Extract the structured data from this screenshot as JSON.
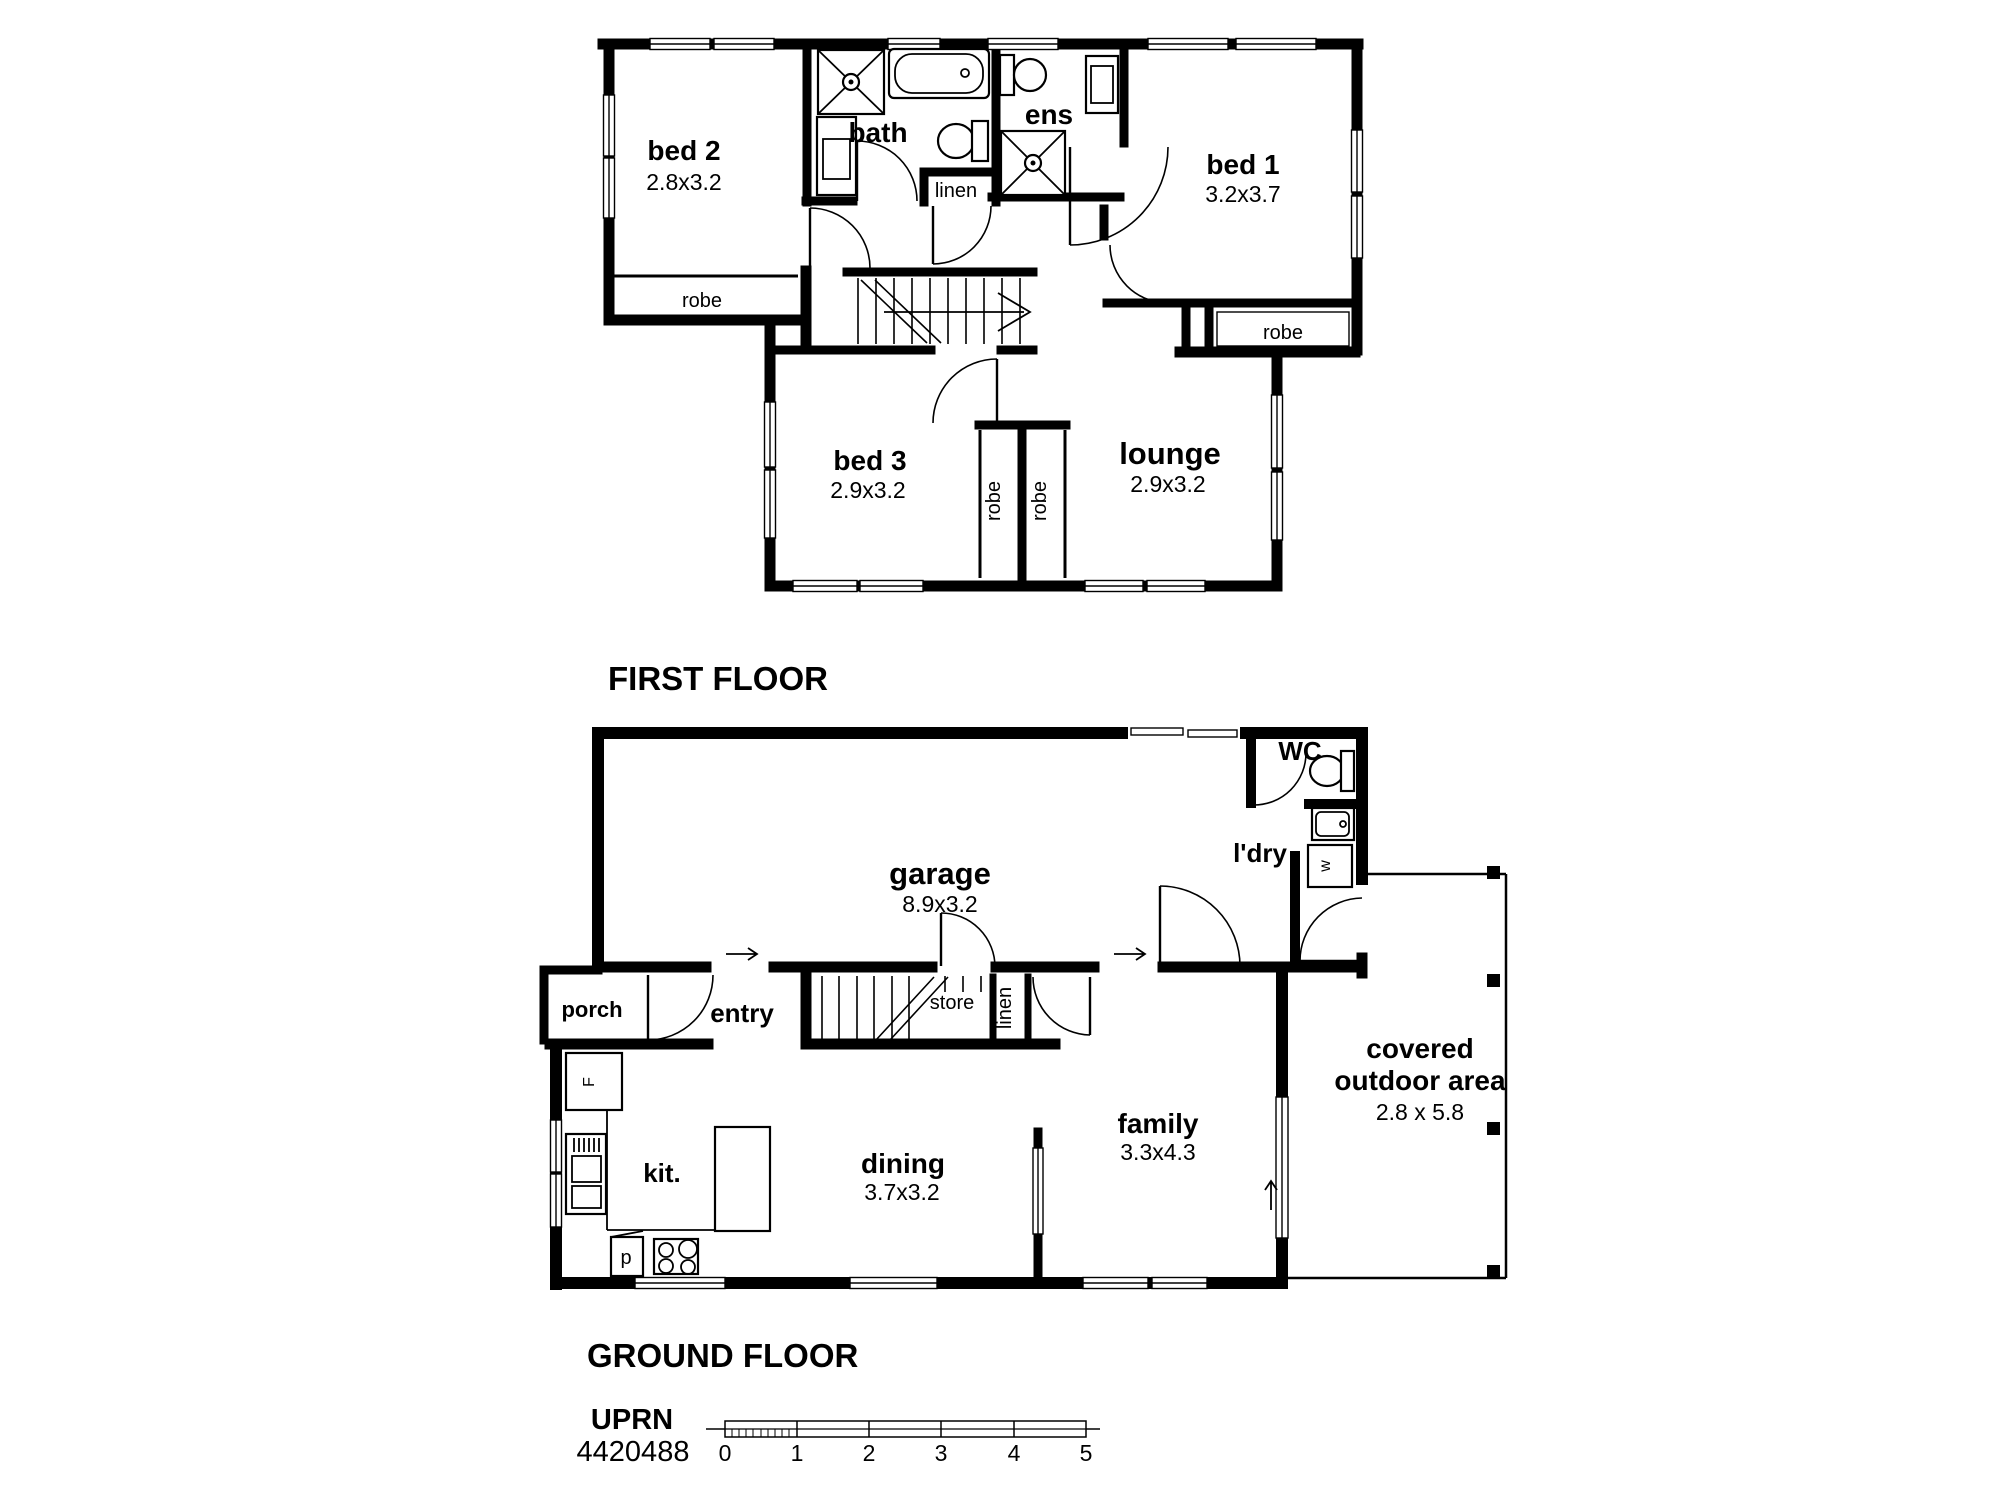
{
  "first_floor": {
    "title": "FIRST FLOOR",
    "bed2": {
      "name": "bed 2",
      "dims": "2.8x3.2"
    },
    "bed1": {
      "name": "bed 1",
      "dims": "3.2x3.7"
    },
    "bed3": {
      "name": "bed 3",
      "dims": "2.9x3.2"
    },
    "lounge": {
      "name": "lounge",
      "dims": "2.9x3.2"
    },
    "bath": {
      "name": "bath"
    },
    "ens": {
      "name": "ens"
    },
    "linen": "linen",
    "robe_bed2": "robe",
    "robe_bed1": "robe",
    "robe_bed3": "robe",
    "robe_lounge": "robe"
  },
  "ground_floor": {
    "title": "GROUND FLOOR",
    "garage": {
      "name": "garage",
      "dims": "8.9x3.2"
    },
    "wc": "WC",
    "ldry": "l'dry",
    "porch": "porch",
    "entry": "entry",
    "store": "store",
    "linen": "linen",
    "kitchen": {
      "name": "kit."
    },
    "dining": {
      "name": "dining",
      "dims": "3.7x3.2"
    },
    "family": {
      "name": "family",
      "dims": "3.3x4.3"
    },
    "outdoor": {
      "line1": "covered",
      "line2": "outdoor area",
      "dims": "2.8 x 5.8"
    },
    "fridge": "F",
    "pantry": "p",
    "washer": "w"
  },
  "footer": {
    "uprn_label": "UPRN",
    "uprn_number": "4420488",
    "scale_numbers": [
      "0",
      "1",
      "2",
      "3",
      "4",
      "5"
    ]
  },
  "colors": {
    "wall": "#000000",
    "background": "#ffffff"
  }
}
